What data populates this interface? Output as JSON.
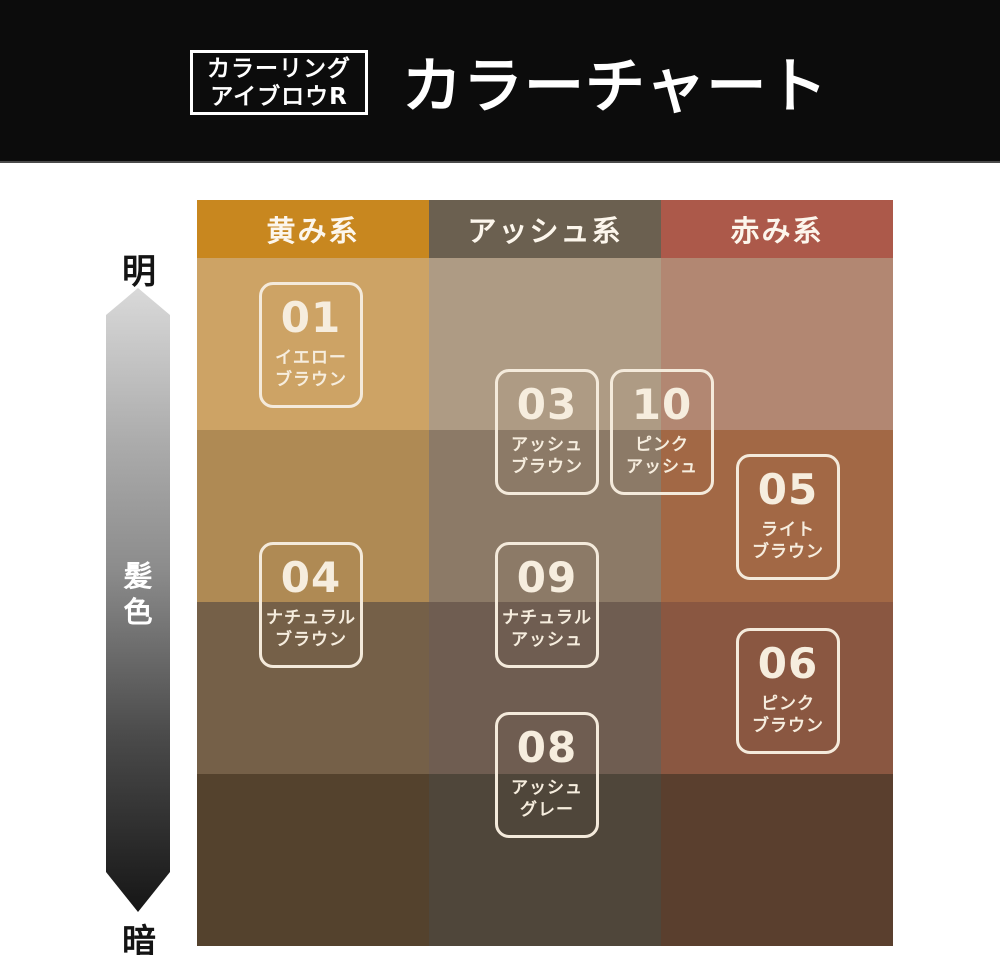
{
  "banner": {
    "bg_color": "#0C0C0C",
    "product_name_line1": "カラーリング",
    "product_name_line2": "アイブロウR",
    "title": "カラーチャート"
  },
  "brightness_axis": {
    "top_label": "明",
    "bottom_label": "暗",
    "middle_label_char1": "髪",
    "middle_label_char2": "色"
  },
  "columns": [
    {
      "label": "黄み系",
      "header_color": "#C8871F",
      "shades": [
        "#CDA365",
        "#AF8A54",
        "#756048",
        "#54422D"
      ]
    },
    {
      "label": "アッシュ系",
      "header_color": "#6B6050",
      "shades": [
        "#AE9B84",
        "#8C7A67",
        "#6F5D51",
        "#4F463A"
      ]
    },
    {
      "label": "赤み系",
      "header_color": "#AC594A",
      "shades": [
        "#B28772",
        "#A26845",
        "#8A5741",
        "#5A3F2E"
      ]
    }
  ],
  "swatches": [
    {
      "number": "01",
      "name_line1": "イエロー",
      "name_line2": "ブラウン"
    },
    {
      "number": "03",
      "name_line1": "アッシュ",
      "name_line2": "ブラウン"
    },
    {
      "number": "10",
      "name_line1": "ピンク",
      "name_line2": "アッシュ"
    },
    {
      "number": "05",
      "name_line1": "ライト",
      "name_line2": "ブラウン"
    },
    {
      "number": "04",
      "name_line1": "ナチュラル",
      "name_line2": "ブラウン"
    },
    {
      "number": "09",
      "name_line1": "ナチュラル",
      "name_line2": "アッシュ"
    },
    {
      "number": "06",
      "name_line1": "ピンク",
      "name_line2": "ブラウン"
    },
    {
      "number": "08",
      "name_line1": "アッシュ",
      "name_line2": "グレー"
    }
  ]
}
